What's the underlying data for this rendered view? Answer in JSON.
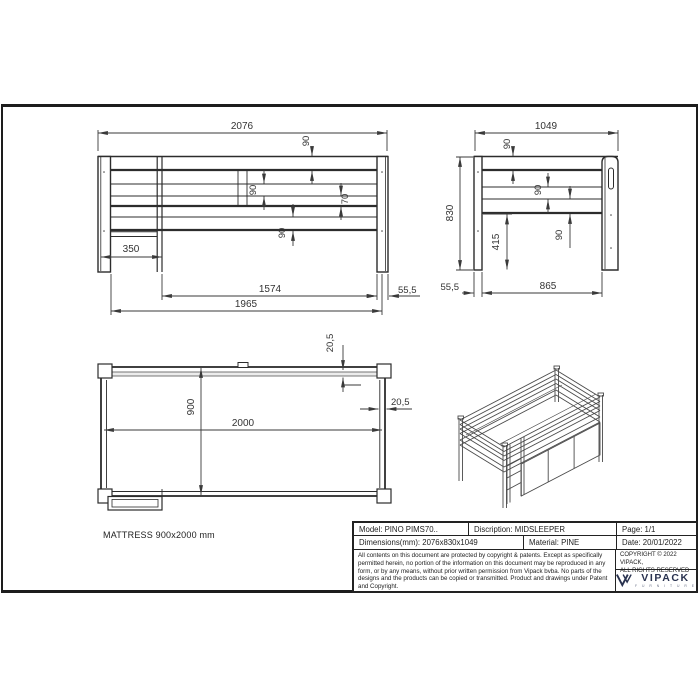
{
  "views": {
    "front": {
      "overall_width": "2076",
      "rail_90_top": "90",
      "rail_90_mid": "90",
      "gap_70": "70",
      "rail_90_base": "90",
      "ladder_inset": "350",
      "frame_length": "1574",
      "outer_length": "1965",
      "post_thickness": "55,5"
    },
    "side": {
      "overall_depth": "1049",
      "rail_90_top": "90",
      "rail_90_mid": "90",
      "rail_90_base": "90",
      "overall_height": "830",
      "under_clearance": "415",
      "post_thickness": "55,5",
      "frame_depth": "865"
    },
    "top": {
      "plank_20_5_top": "20,5",
      "plank_20_5_side": "20,5",
      "inner_width": "900",
      "inner_length": "2000"
    },
    "mattress_note": "MATTRESS 900x2000 mm"
  },
  "title_block": {
    "model": "Model: PINO PIMS70..",
    "description": "Discription: MIDSLEEPER",
    "page": "Page: 1/1",
    "dimensions": "Dimensions(mm): 2076x830x1049",
    "material": "Material: PINE",
    "date": "Date: 20/01/2022",
    "copyright_notice": "All contents on this document are protected by copyright & patents. Except as specifically permitted herein, no portion of the information on this document may be reproduced in any form, or by any means, without prior written permission from Vipack bvba. No parts of the designs and the products can be copied or transmitted. Product and drawings under Patent and Copyright.",
    "copyright_line1": "COPYRIGHT  © 2022 VIPACK,",
    "copyright_line2": "ALL RIGHTS RESERVED",
    "brand": "VIPACK",
    "brand_sub": "F U R N I T U R E"
  },
  "colors": {
    "line": "#2c2c2c",
    "dim": "#3a3a3a",
    "brand_navy": "#29324f"
  }
}
